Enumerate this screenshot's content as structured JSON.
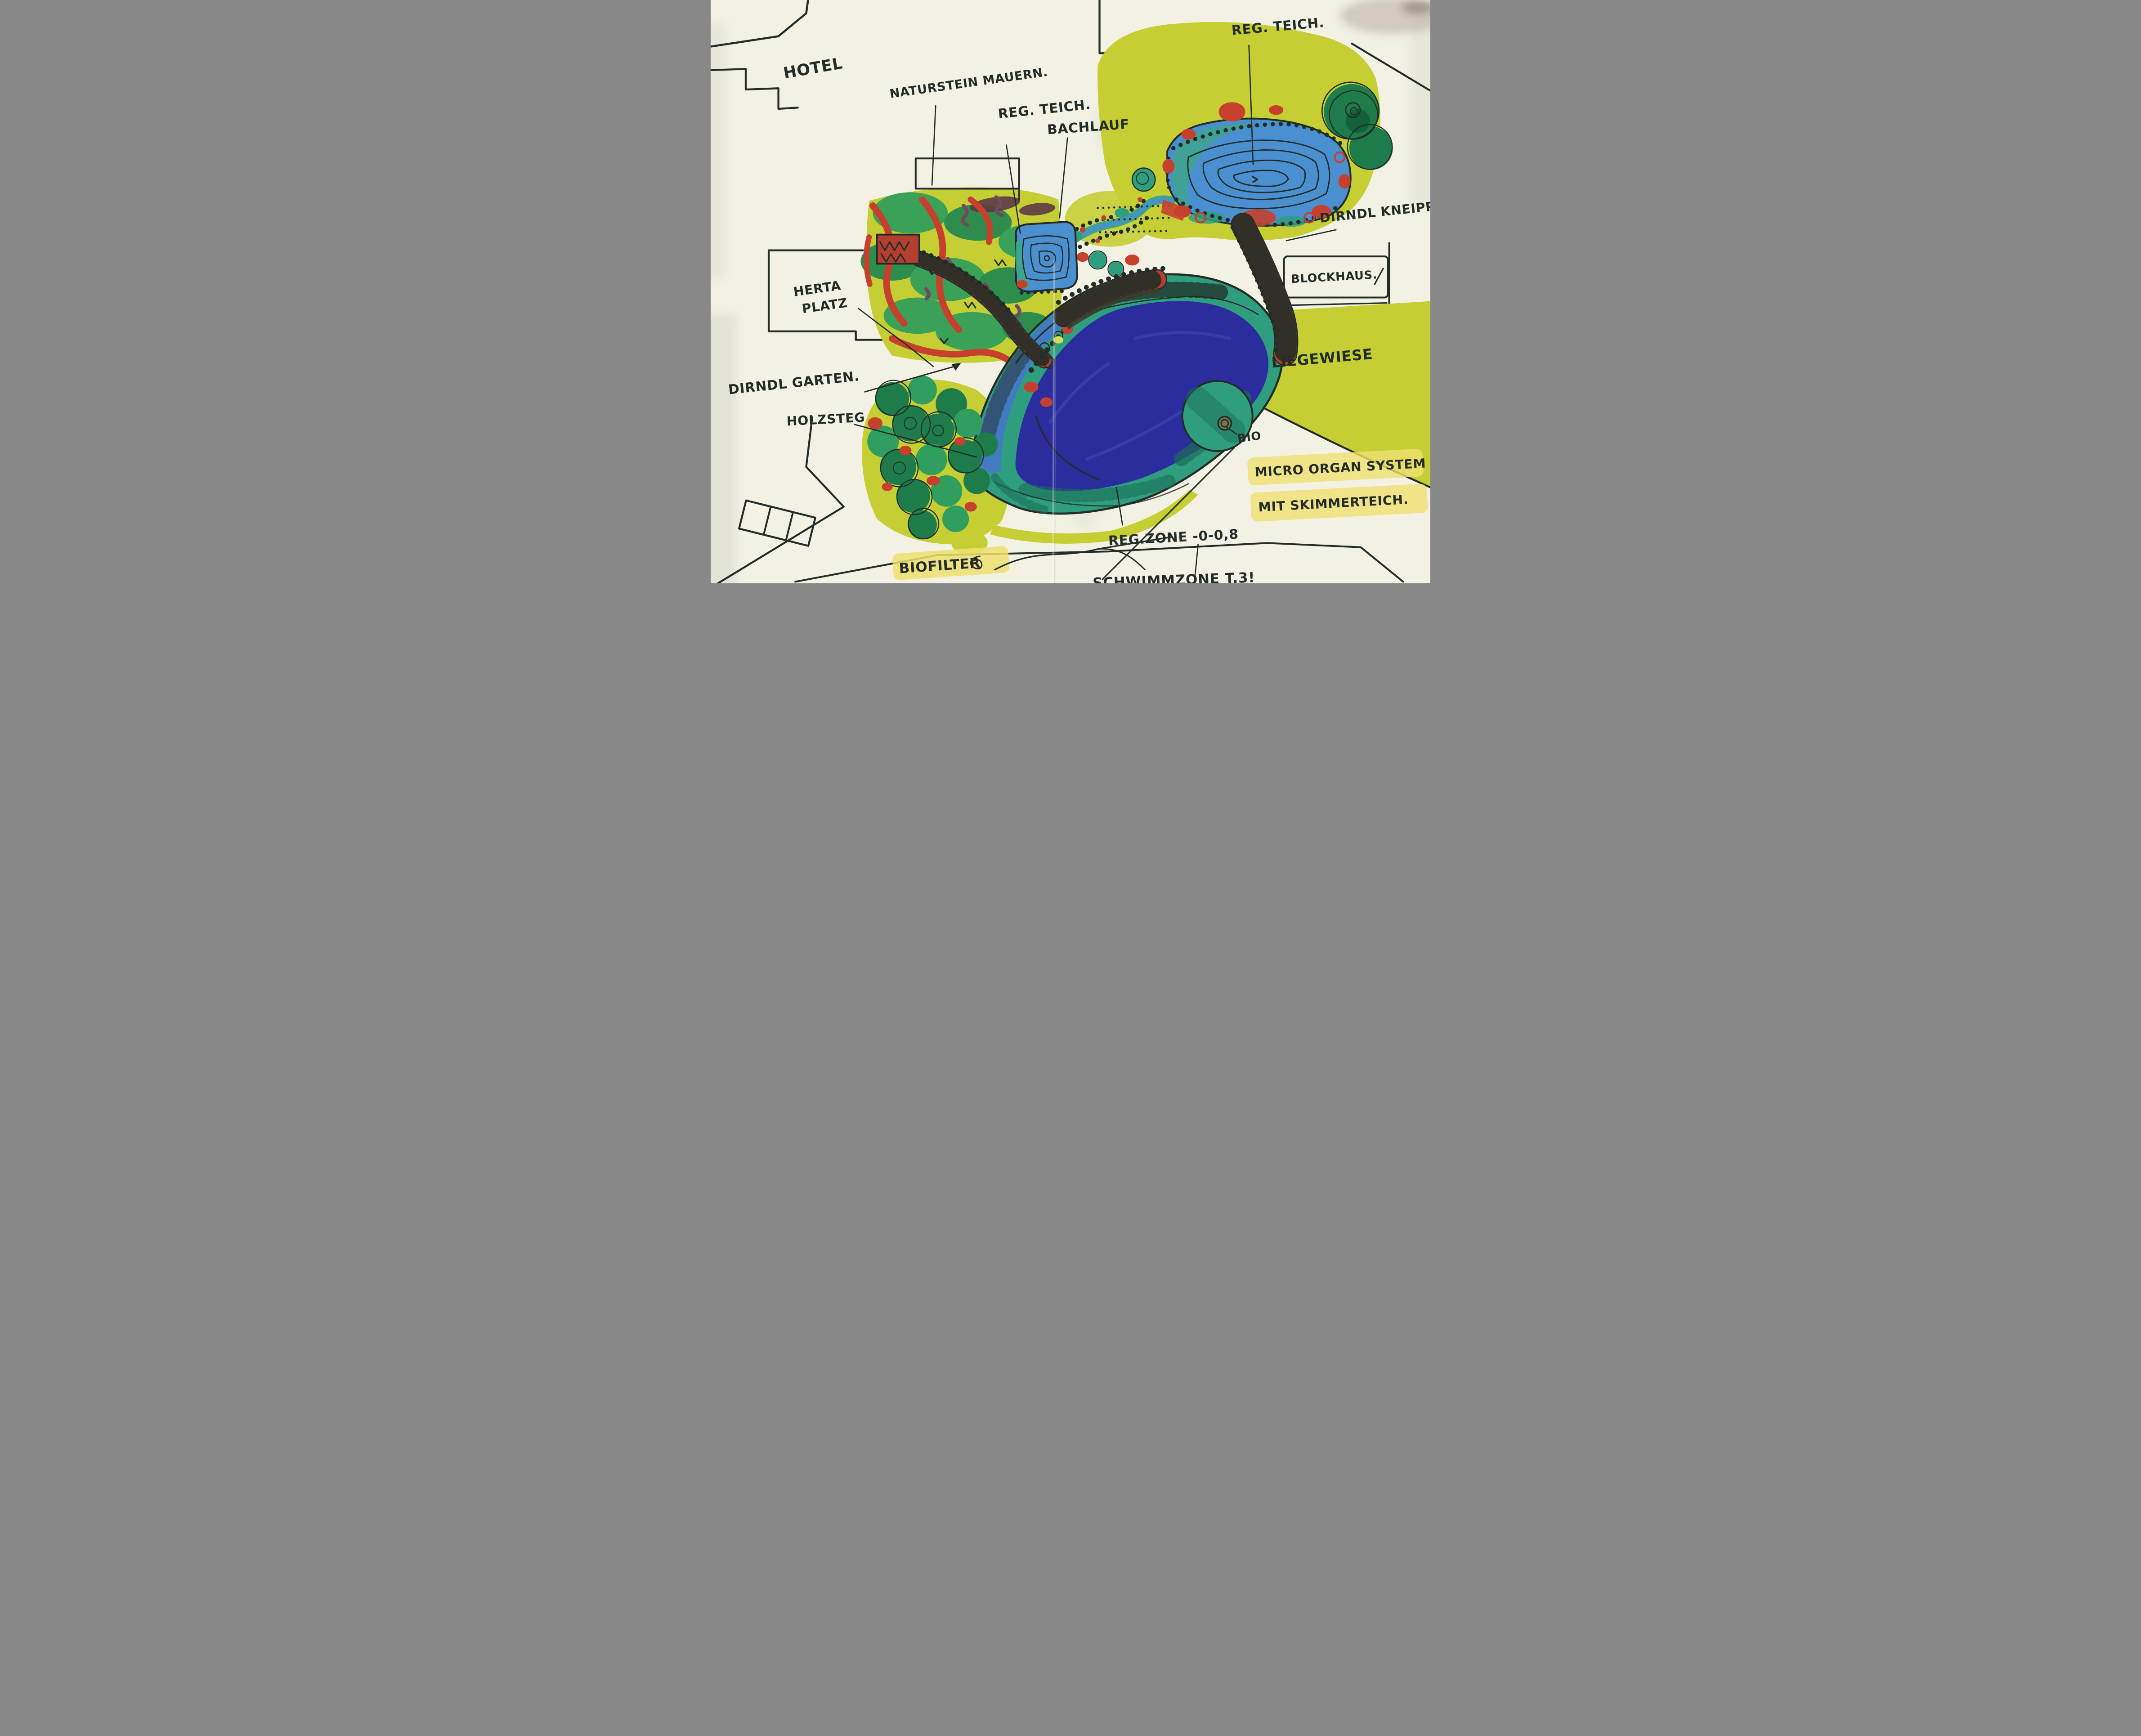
{
  "labels": {
    "hotel": "HOTEL",
    "naturstein_mauern": "NATURSTEIN MAUERN.",
    "reg_teich_mitte": "REG. TEICH.",
    "bachlauf": "BACHLAUF",
    "reg_teich_oben": "REG. TEICH.",
    "dirndl_kneipp": "DIRNDL KNEIPPA",
    "blockhaus": "BLOCKHAUS.",
    "liegewiese": "LIEGEWIESE",
    "herta_line1": "HERTA",
    "herta_line2": "PLATZ",
    "dirndl_garten": "DIRNDL GARTEN.",
    "holzsteg": "HOLZSTEG",
    "bio": "BIO",
    "micro_line1": "MICRO ORGAN SYSTEM",
    "micro_line2": "MIT SKIMMERTEICH.",
    "reg_zone": "REG.ZONE  -0-0,8",
    "biofilter": "BIOFILTER",
    "schwimmzone": "SCHWIMMZONE  T.3!"
  },
  "colors": {
    "paper": "#f2f1e4",
    "ink": "#232d28",
    "meadow": "#c5cf33",
    "meadowLight": "#d6dd55",
    "grass": "#3aa158",
    "grassDark": "#2e8c4d",
    "tree": "#1e7c4b",
    "treeDark": "#14603b",
    "red": "#c7402e",
    "brick": "#b23f30",
    "pondBlue": "#4a8fd0",
    "poolNavy": "#2b2d9e",
    "poolBlue": "#4478c8",
    "teal": "#2f9e7f",
    "tealDark": "#1d6e58",
    "streamTeal": "#3ea58c",
    "highlight": "#efe070",
    "shadowGray": "#dcdcd0",
    "smudge": "#b3a49c",
    "purple": "#6f4b5e",
    "darkOlive": "#3c3c2a"
  }
}
